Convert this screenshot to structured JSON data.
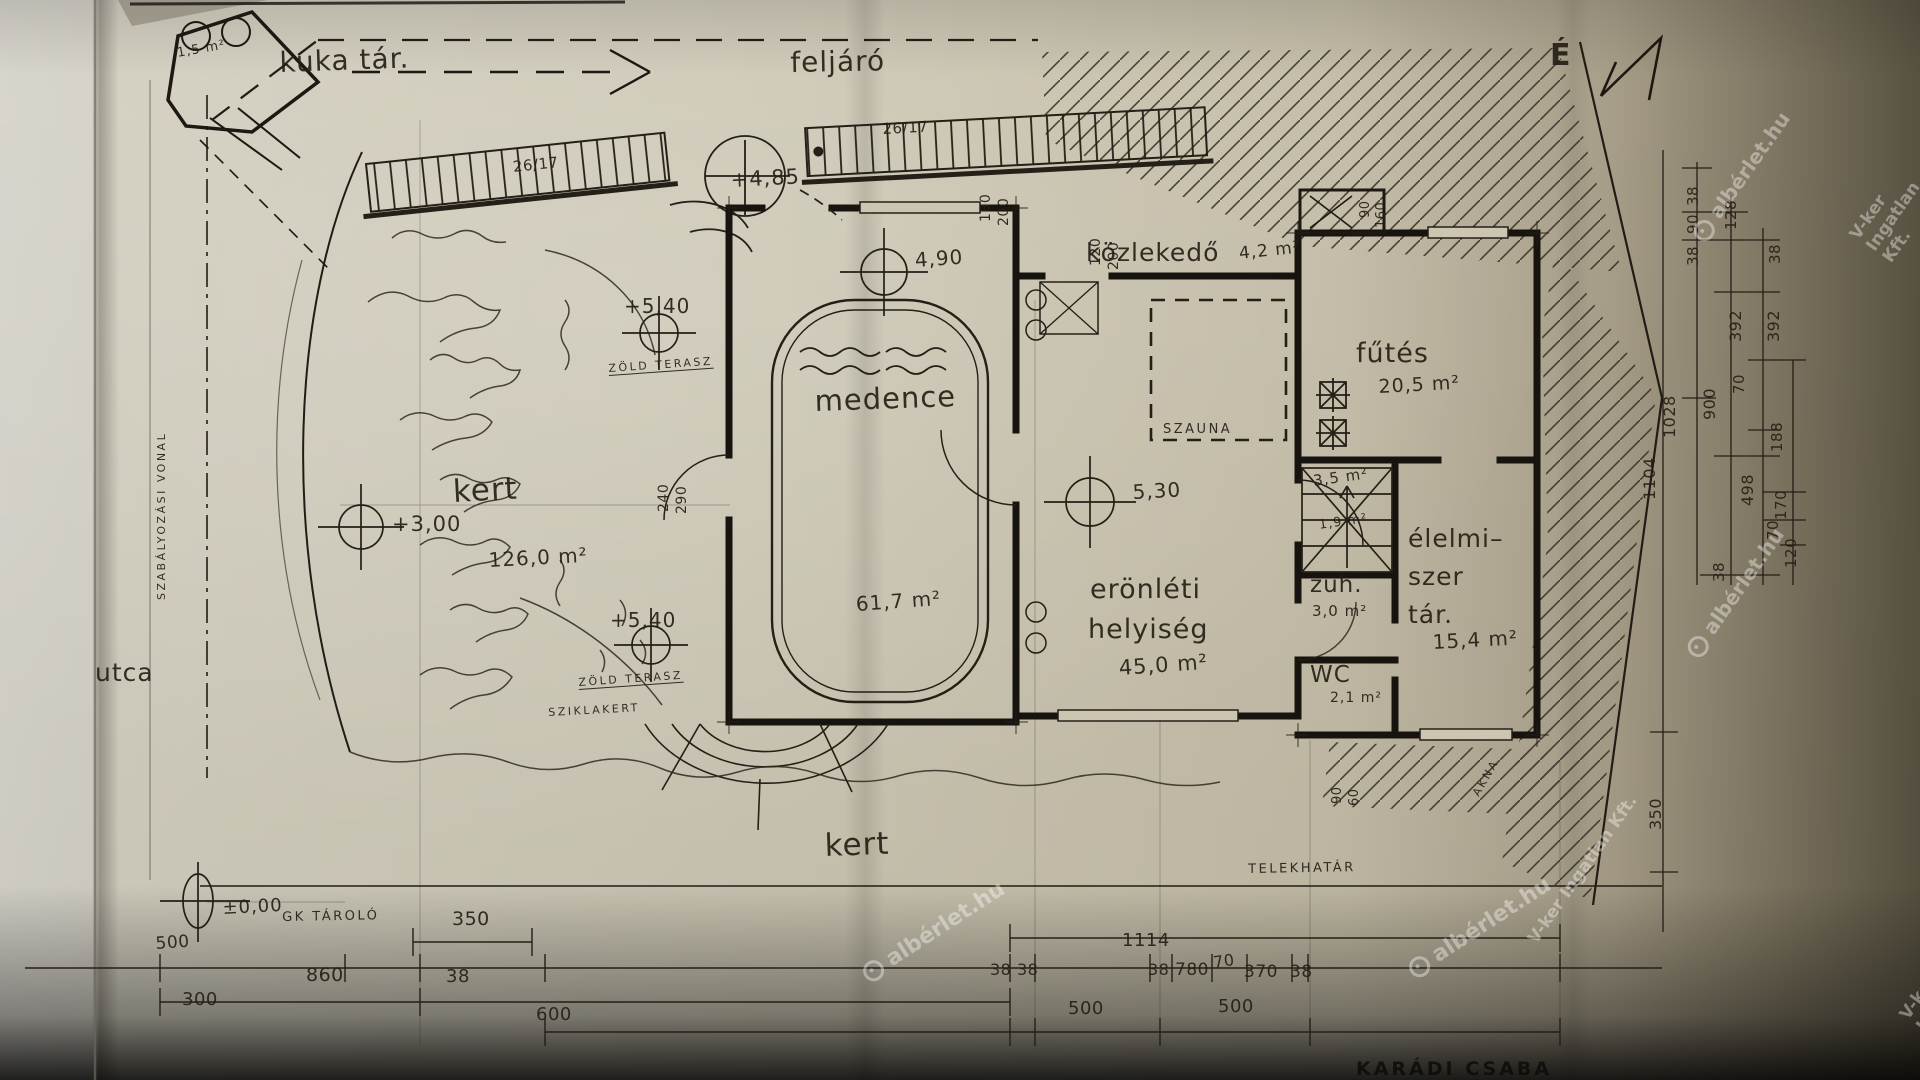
{
  "page": {
    "north_letter": "É",
    "signature": "KARÁDI CSABA"
  },
  "site": {
    "street": "utca",
    "regulation_line": "SZABÁLYOZÁSI VONAL",
    "plot_boundary": "TELEKHATÁR",
    "garage_store": "GK TÁROLÓ",
    "trash_store": {
      "name": "kuka tár.",
      "area": "1,5 m²"
    },
    "ramp": "feljáró",
    "garden_upper": {
      "name": "kert",
      "area": "126,0 m²"
    },
    "garden_lower": "kert",
    "green_terrace_1": "ZÖLD TERASZ",
    "green_terrace_2": "ZÖLD TERASZ",
    "rock_garden": "SZIKLAKERT",
    "shaft": "AKNA"
  },
  "rooms": {
    "corridor": {
      "name": "közlekedő",
      "area": "4,2 m²"
    },
    "heating": {
      "name": "fűtés",
      "area": "20,5 m²"
    },
    "pool": {
      "name": "medence",
      "area": "61,7 m²"
    },
    "fitness": {
      "line1": "erönléti",
      "line2": "helyiség",
      "area": "45,0 m²"
    },
    "sauna": {
      "name": "SZAUNA"
    },
    "stair_hall": {
      "area": "3,5 m²",
      "area_small": "1,9 m²"
    },
    "shower": {
      "name": "zuh.",
      "area": "3,0 m²"
    },
    "wc": {
      "name": "WC",
      "area": "2,1 m²"
    },
    "pantry": {
      "line1": "élelmi–",
      "line2": "szer",
      "line3": "tár.",
      "area": "15,4 m²"
    }
  },
  "levels": {
    "ground": "±0,00",
    "garden": "+3,00",
    "terrace_a": "+5,40",
    "terrace_b": "+5,40",
    "entry": "+4,85",
    "corridor": "4,90",
    "fitness": "5,30"
  },
  "stairs": {
    "run_top_left": "26/17",
    "run_top_right": "26/17"
  },
  "openings": {
    "win1_w": "180",
    "win1_h": "200",
    "win2_w": "120",
    "win2_h": "200",
    "door_top_w": "90",
    "door_top_h": "160",
    "door_bottom_w": "90",
    "door_bottom_h": "60",
    "pool_door_w": "240",
    "pool_door_h": "290"
  },
  "dims": {
    "bottom": {
      "d350": "350",
      "d500a": "500",
      "d860": "860",
      "d300": "300",
      "d38a": "38",
      "d600": "600",
      "d1114": "1114",
      "d3838": "38 38",
      "d38b": "38",
      "d780": "780",
      "d70": "70",
      "d370": "370",
      "d38c": "38",
      "d500b": "500",
      "d500c": "500"
    },
    "right": [
      "38",
      "90",
      "38",
      "128",
      "38",
      "392",
      "392",
      "1028",
      "900",
      "70",
      "188",
      "498",
      "170",
      "70",
      "120",
      "38",
      "1104",
      "350"
    ]
  },
  "watermarks": {
    "brand": "albérlet.hu",
    "agency": "V-ker Ingatlan Kft."
  }
}
